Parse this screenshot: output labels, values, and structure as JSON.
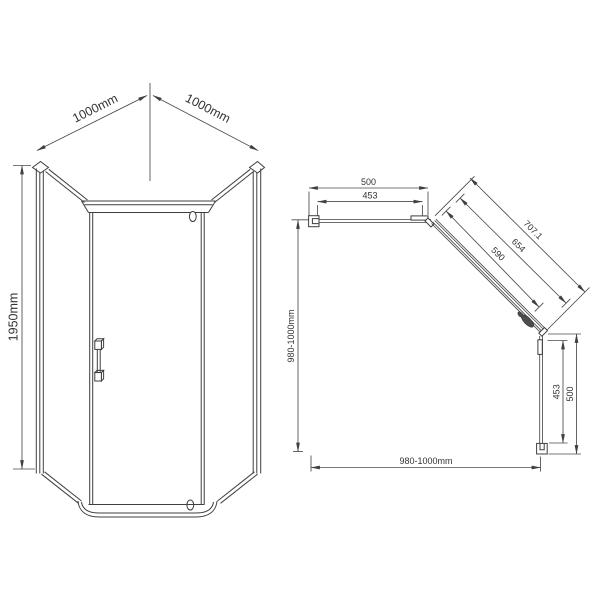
{
  "front_view": {
    "width_left_label": "1000mm",
    "width_right_label": "1000mm",
    "height_label": "1950mm"
  },
  "plan_view": {
    "top_width_label": "500",
    "top_glass_label": "453",
    "diagonal_outer_label": "707.1",
    "diagonal_middle_label": "654",
    "diagonal_inner_label": "590",
    "right_glass_label": "453",
    "right_width_label": "500",
    "left_overall_label": "980-1000mm",
    "bottom_overall_label": "980-1000mm"
  },
  "colors": {
    "line": "#3f3f3f",
    "text": "#333333",
    "background": "#ffffff"
  }
}
